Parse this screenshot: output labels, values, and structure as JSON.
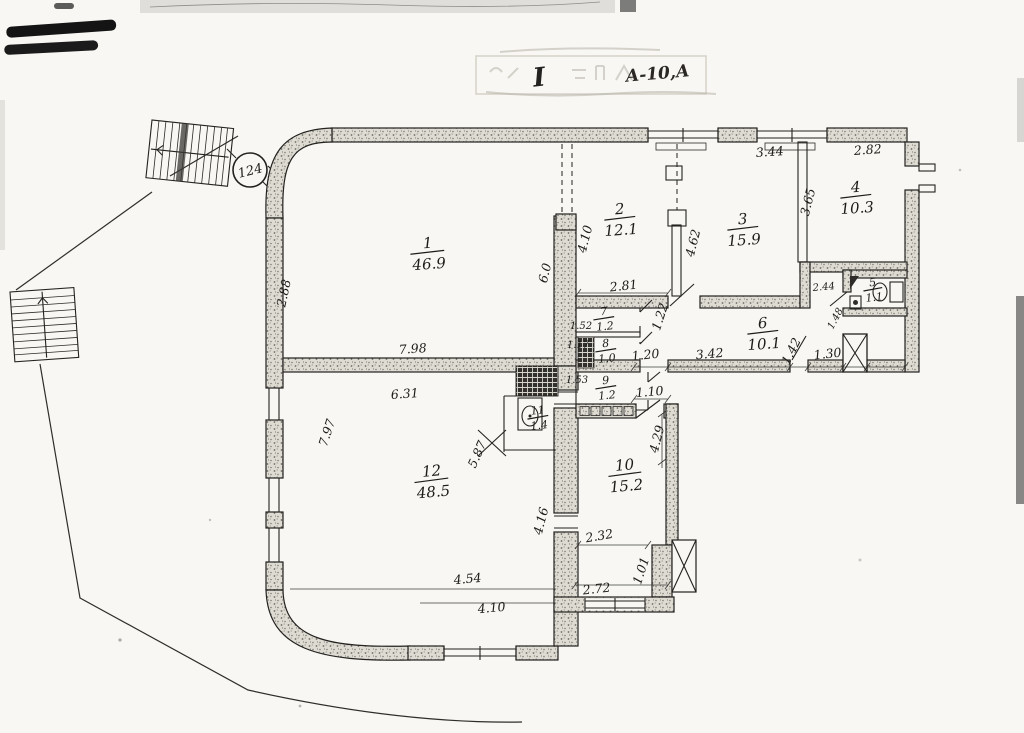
{
  "stamp": {
    "roman": "I",
    "handwritten": "А-10,А"
  },
  "site_number": "124",
  "rooms": [
    {
      "number": "1",
      "area": "46.9"
    },
    {
      "number": "2",
      "area": "12.1"
    },
    {
      "number": "3",
      "area": "15.9"
    },
    {
      "number": "4",
      "area": "10.3"
    },
    {
      "number": "5",
      "area": "1.1"
    },
    {
      "number": "6",
      "area": "10.1"
    },
    {
      "number": "7",
      "area": "1.2"
    },
    {
      "number": "8",
      "area": "1.0"
    },
    {
      "number": "9",
      "area": "1.2"
    },
    {
      "number": "10",
      "area": "15.2"
    },
    {
      "number": "11",
      "area": "1.4"
    },
    {
      "number": "12",
      "area": "48.5"
    }
  ],
  "dims": {
    "room3_top": "3.44",
    "room4_top": "2.82",
    "room1_left": "2.88",
    "room1_width": "7.98",
    "room2_left": "4.10",
    "hall_height": "6.0",
    "room3_left": "4.62",
    "room4_left": "3.65",
    "wc_top": "2.44",
    "wc_diag": "1.48",
    "room2_bottom": "2.81",
    "room7_right": "1.22",
    "room7_left": "1.52",
    "room8_left": "1.17",
    "room9_left": "1.53",
    "room9_width": "1.10",
    "corridor_a": "1.20",
    "corridor_b": "3.42",
    "corridor_door": "1.42",
    "corridor_c": "1.30",
    "room12_top": "6.31",
    "room12_left": "7.97",
    "room12_diag": "5.87",
    "room10_side": "4.29",
    "room10_mid": "4.16",
    "room10_inner": "2.32",
    "room10_bottom": "2.72",
    "room10_right": "1.01",
    "bottom_a": "4.54",
    "bottom_b": "4.10"
  },
  "colors": {
    "paper": "#f8f7f3",
    "ink": "#1d1c1a",
    "wall_fill": "#dedbd3"
  }
}
